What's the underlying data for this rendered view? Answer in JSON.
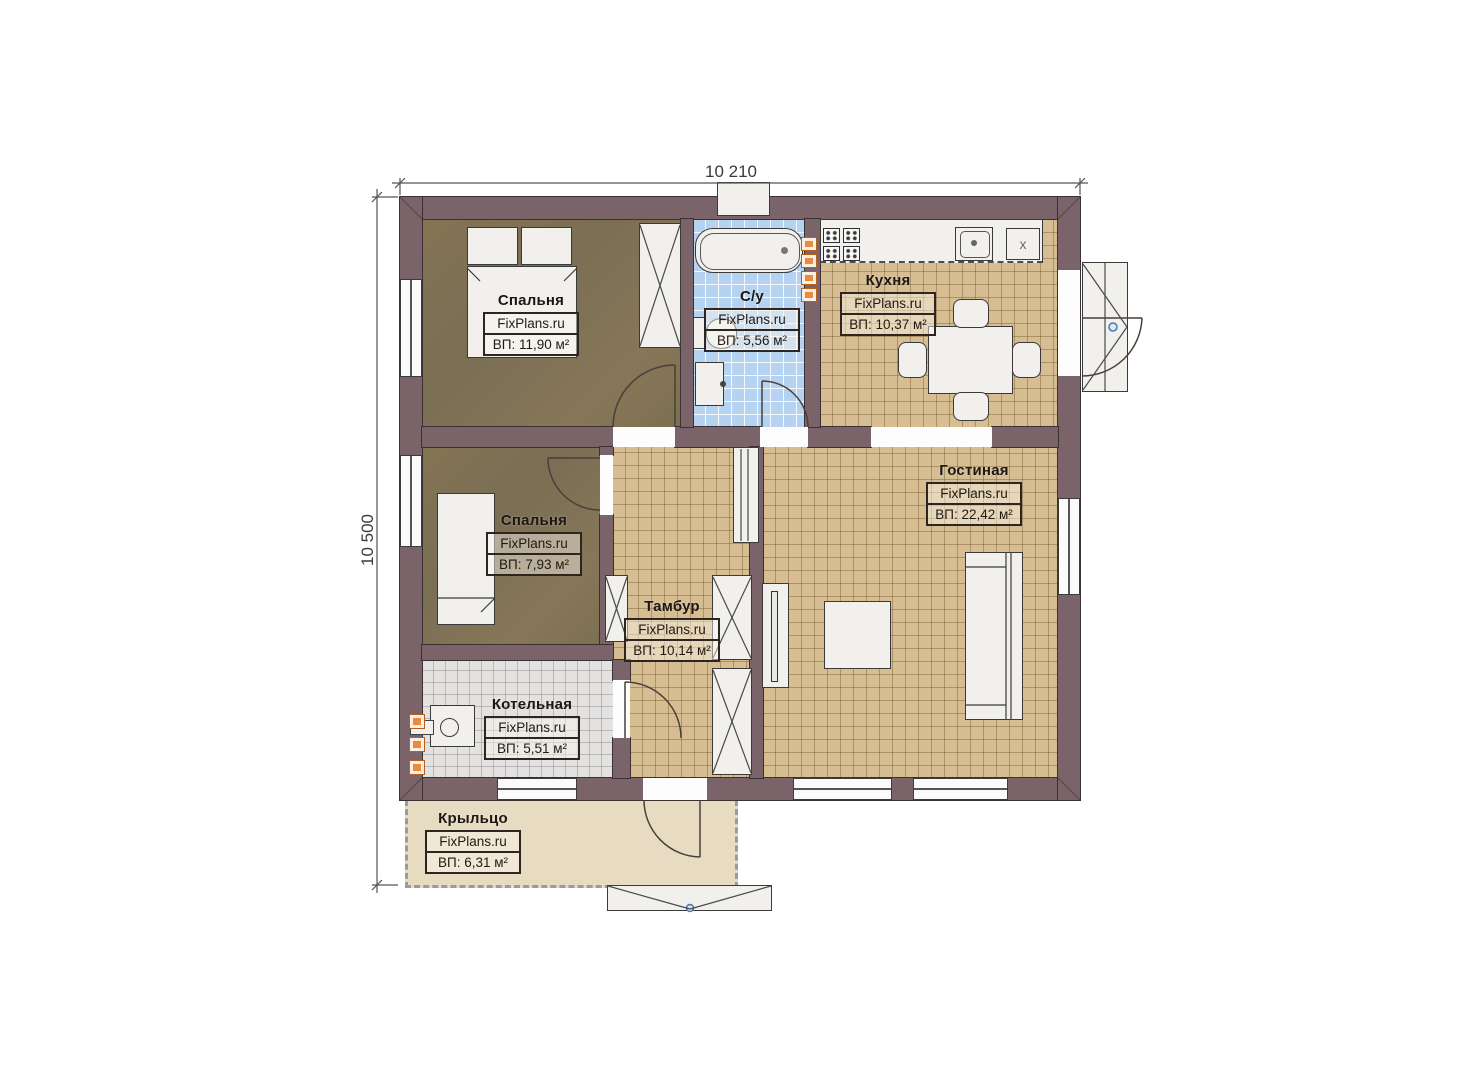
{
  "dimensions": {
    "width": "10 210",
    "height": "10 500"
  },
  "rooms": [
    {
      "name": "Спальня",
      "watermark": "FixPlans.ru",
      "area": "ВП: 11,90 м²"
    },
    {
      "name": "С/у",
      "watermark": "FixPlans.ru",
      "area": "ВП: 5,56 м²"
    },
    {
      "name": "Кухня",
      "watermark": "FixPlans.ru",
      "area": "ВП: 10,37 м²"
    },
    {
      "name": "Гостиная",
      "watermark": "FixPlans.ru",
      "area": "ВП: 22,42 м²"
    },
    {
      "name": "Спальня",
      "watermark": "FixPlans.ru",
      "area": "ВП: 7,93 м²"
    },
    {
      "name": "Тамбур",
      "watermark": "FixPlans.ru",
      "area": "ВП: 10,14 м²"
    },
    {
      "name": "Котельная",
      "watermark": "FixPlans.ru",
      "area": "ВП: 5,51 м²"
    },
    {
      "name": "Крыльцо",
      "watermark": "FixPlans.ru",
      "area": "ВП: 6,31 м²"
    }
  ],
  "fixtures": {
    "counter_box_label": "x"
  },
  "colors": {
    "wall": "#7b6469",
    "floor_tan": "#d6bd92",
    "floor_brown": "#7e7153",
    "floor_blue": "#b5d2f1",
    "floor_gray": "#e3e2e0",
    "porch": "#e7dbc2",
    "chimney_orange": "#e98a3c",
    "door_pivot_blue": "#4a78b0"
  }
}
